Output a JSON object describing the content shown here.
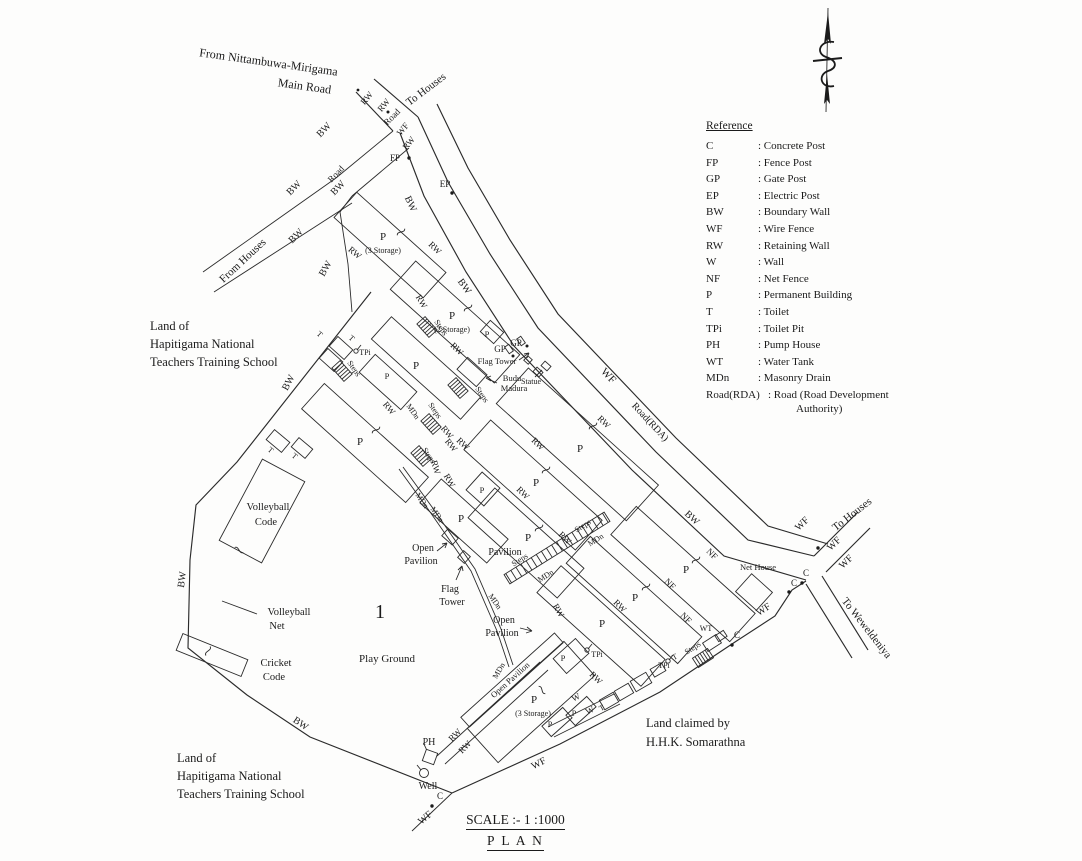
{
  "page": {
    "background": "#fdfdfc",
    "ink": "#1b1b1b"
  },
  "legend": {
    "title": "Reference",
    "entries": [
      {
        "abbr": "C",
        "desc": ": Concrete Post"
      },
      {
        "abbr": "FP",
        "desc": ": Fence Post"
      },
      {
        "abbr": "GP",
        "desc": ": Gate Post"
      },
      {
        "abbr": "EP",
        "desc": ": Electric Post"
      },
      {
        "abbr": "BW",
        "desc": ": Boundary Wall"
      },
      {
        "abbr": "WF",
        "desc": ": Wire Fence"
      },
      {
        "abbr": "RW",
        "desc": ": Retaining Wall"
      },
      {
        "abbr": "W",
        "desc": ": Wall"
      },
      {
        "abbr": "NF",
        "desc": ": Net Fence"
      },
      {
        "abbr": "P",
        "desc": ": Permanent Building"
      },
      {
        "abbr": "T",
        "desc": ": Toilet"
      },
      {
        "abbr": "TPi",
        "desc": ": Toilet Pit"
      },
      {
        "abbr": "PH",
        "desc": ": Pump House"
      },
      {
        "abbr": "WT",
        "desc": ": Water Tank"
      },
      {
        "abbr": "MDn",
        "desc": ": Masonry Drain"
      },
      {
        "abbr": "Road(RDA)",
        "desc": ": Road (Road Development",
        "desc_cont": "Authority)"
      }
    ]
  },
  "labels": {
    "c": "C",
    "fp": "FP",
    "gp": "GP",
    "ep": "EP",
    "bw": "BW",
    "wf": "WF",
    "rw": "RW",
    "w": "W",
    "nf": "NF",
    "p": "P",
    "t": "T",
    "tpi": "TPi",
    "ph": "PH",
    "wt": "WT",
    "mdn": "MDn",
    "steps": "Steps",
    "road": "Road",
    "road_rda": "Road(RDA)",
    "well": "Well",
    "storage3": "(3 Storage)",
    "storage2": "(2 Storage)"
  },
  "texts": {
    "from_main_road_line1": "From Nittambuwa-Mirigama",
    "from_main_road_line2": "Main Road",
    "to_houses": "To Houses",
    "from_houses": "From Houses",
    "to_weweldeniya": "To Weweldeniya",
    "land_of_line1": "Land of",
    "land_of_line2": "Hapitigama National",
    "land_of_line3": "Teachers Training School",
    "land_claimed_line1": "Land claimed by",
    "land_claimed_line2": "H.H.K. Somarathna",
    "volleyball": "Volleyball",
    "code": "Code",
    "net": "Net",
    "cricket": "Cricket",
    "play_ground": "Play Ground",
    "plot_number": "1",
    "open": "Open",
    "pavilion": "Pavilion",
    "open_pavilion": "Open Pavilion",
    "flag": "Flag",
    "tower": "Tower",
    "flag_tower": "Flag Tower",
    "budu": "Budu",
    "madura": "Madura",
    "statue": "Statue",
    "net_house": "Net House",
    "scale": "SCALE :- 1 :1000",
    "plan": "P L A N"
  }
}
